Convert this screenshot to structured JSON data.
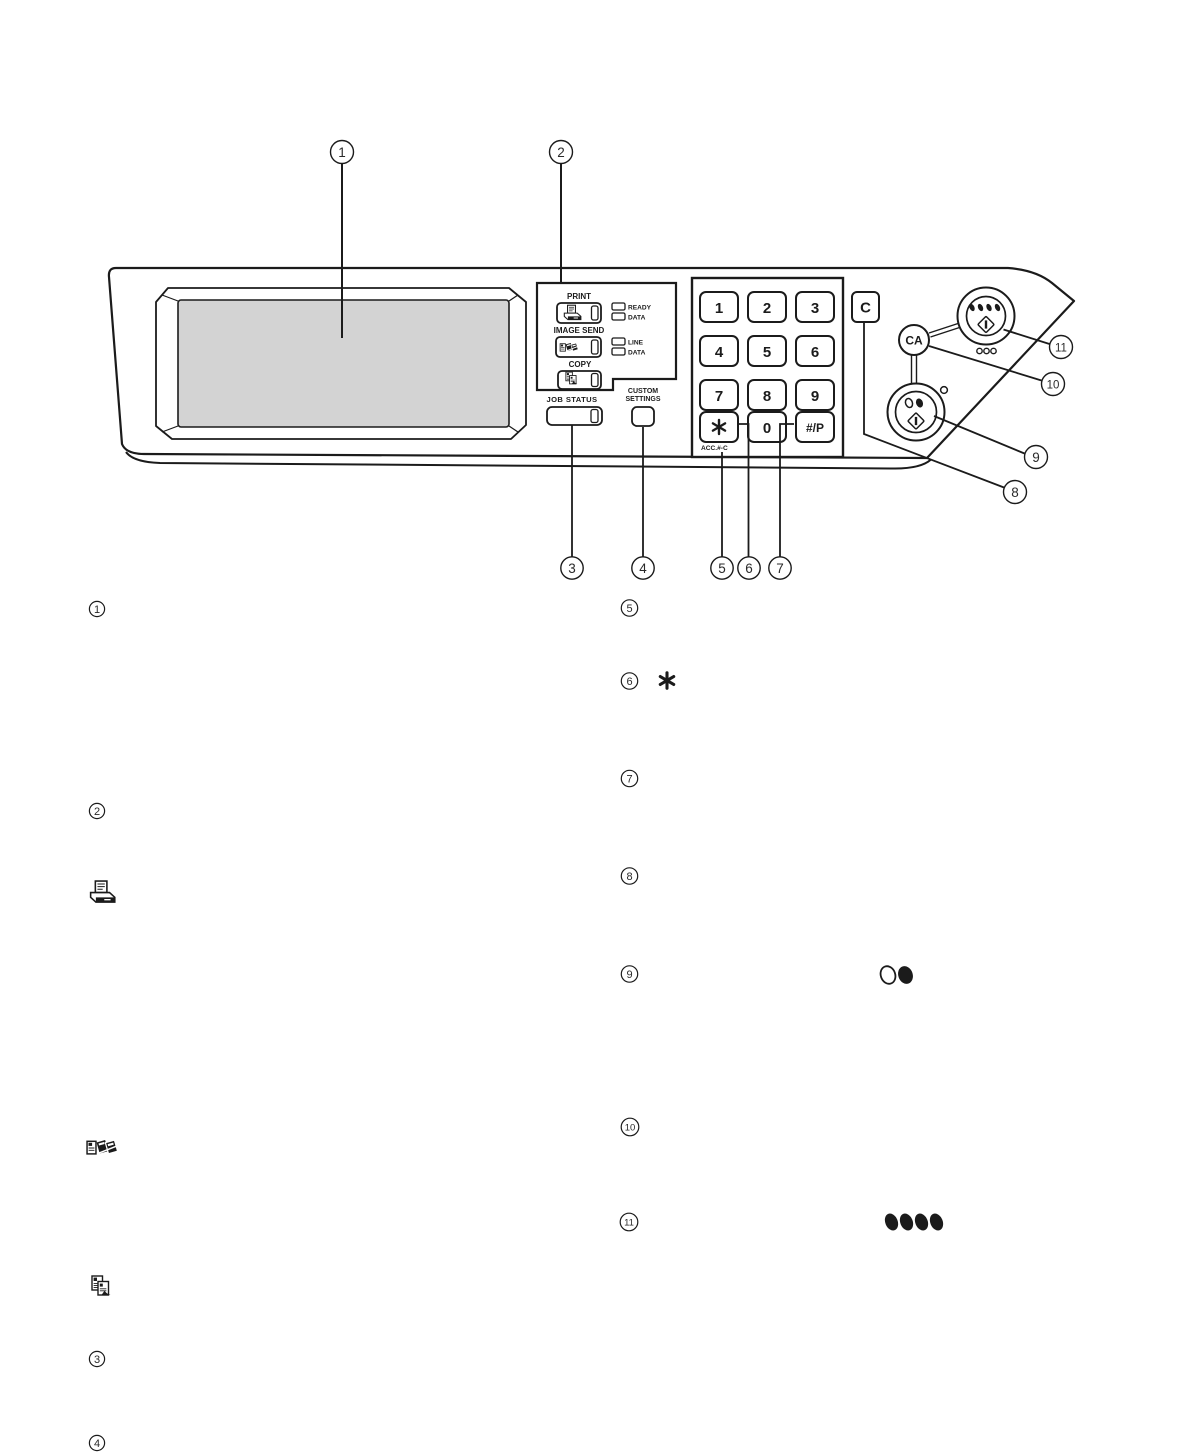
{
  "panel": {
    "mode_select": {
      "print_label": "PRINT",
      "image_send_label": "IMAGE SEND",
      "copy_label": "COPY",
      "ready_label": "READY",
      "data_print_label": "DATA",
      "line_label": "LINE",
      "data_send_label": "DATA"
    },
    "job_status_label": "JOB STATUS",
    "custom_settings_label_line1": "CUSTOM",
    "custom_settings_label_line2": "SETTINGS",
    "keypad": [
      "1",
      "2",
      "3",
      "4",
      "5",
      "6",
      "7",
      "8",
      "9"
    ],
    "zero_key": "0",
    "hash_key": "#/P",
    "star_key": "✱",
    "acc_label": "ACC.#-C",
    "clear_key_label": "C",
    "clear_all_key_label": "CA"
  },
  "callouts": [
    "1",
    "2",
    "3",
    "4",
    "5",
    "6",
    "7",
    "8",
    "9",
    "10",
    "11"
  ]
}
